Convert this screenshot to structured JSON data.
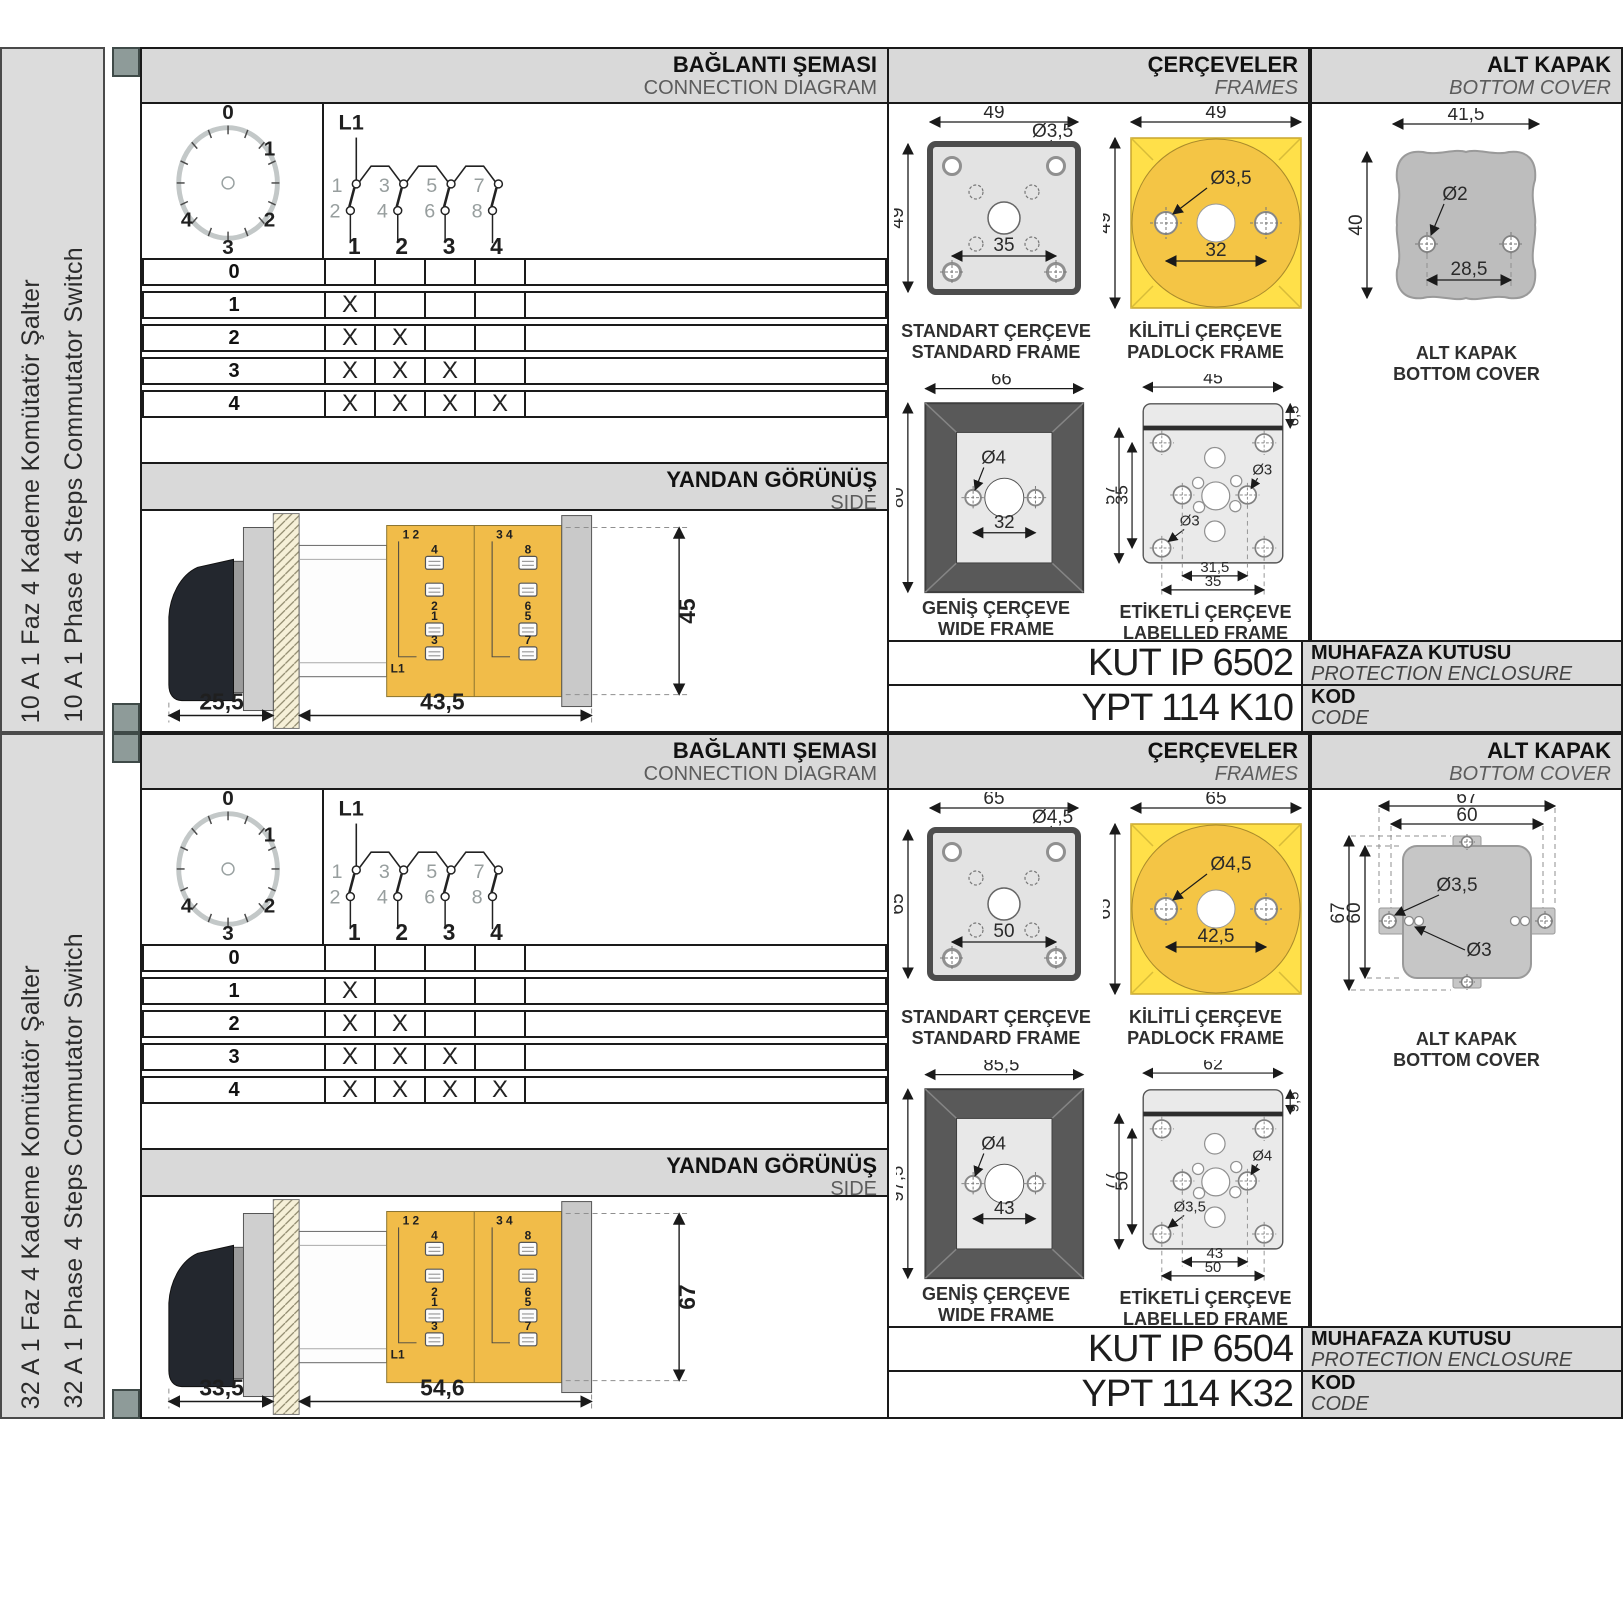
{
  "rows": [
    {
      "sidebar": {
        "title_tr": "10 A 1 Faz 4 Kademe Komütatör Şalter",
        "title_en": "10 A 1 Phase 4 Steps Commutator Switch"
      },
      "connection": {
        "title_tr": "BAĞLANTI ŞEMASI",
        "title_en": "CONNECTION DIAGRAM",
        "dial": {
          "labels": [
            "0",
            "1",
            "2",
            "3",
            "4"
          ]
        },
        "schematic": {
          "input": "L1",
          "top_terminals": [
            "1",
            "3",
            "5",
            "7"
          ],
          "bottom_terminals": [
            "2",
            "4",
            "6",
            "8"
          ],
          "poles": [
            "1",
            "2",
            "3",
            "4"
          ]
        },
        "table": {
          "steps": [
            {
              "step": "0",
              "marks": [
                "",
                "",
                "",
                ""
              ]
            },
            {
              "step": "1",
              "marks": [
                "X",
                "",
                "",
                ""
              ]
            },
            {
              "step": "2",
              "marks": [
                "X",
                "X",
                "",
                ""
              ]
            },
            {
              "step": "3",
              "marks": [
                "X",
                "X",
                "X",
                ""
              ]
            },
            {
              "step": "4",
              "marks": [
                "X",
                "X",
                "X",
                "X"
              ]
            }
          ]
        }
      },
      "side_view": {
        "title_tr": "YANDAN GÖRÜNÜŞ",
        "title_en": "SIDE",
        "dim_handle_depth": "25,5",
        "dim_body_depth": "43,5",
        "dim_height": "45",
        "terminals": {
          "group1": "1 2",
          "group2": "3 4",
          "labels": [
            "4",
            "8",
            "2",
            "6",
            "1",
            "5",
            "3",
            "7"
          ],
          "input": "L1"
        }
      },
      "frames": {
        "title_tr": "ÇERÇEVELER",
        "title_en": "FRAMES",
        "standard": {
          "caption_tr": "STANDART ÇERÇEVE",
          "caption_en": "STANDARD FRAME",
          "dim_width": "49",
          "dim_height": "49",
          "dim_hole": "Ø3,5",
          "dim_pitch": "35"
        },
        "padlock": {
          "caption_tr": "KİLİTLİ ÇERÇEVE",
          "caption_en": "PADLOCK FRAME",
          "dim_width": "49",
          "dim_height": "49",
          "dim_hole": "Ø3,5",
          "dim_pitch": "32"
        },
        "wide": {
          "caption_tr": "GENİŞ ÇERÇEVE",
          "caption_en": "WIDE FRAME",
          "dim_width": "66",
          "dim_height": "80",
          "dim_hole": "Ø4",
          "dim_pitch": "32"
        },
        "labelled": {
          "caption_tr": "ETİKETLİ ÇERÇEVE",
          "caption_en": "LABELLED FRAME",
          "dim_width": "45",
          "dim_band": "6,5",
          "dim_height": "57",
          "dim_inner_height": "35",
          "dim_hole_mid": "Ø3",
          "dim_hole_corner": "Ø3",
          "dim_pitch_inner": "31,5",
          "dim_pitch_outer": "35"
        }
      },
      "bottom_cover": {
        "title_tr": "ALT KAPAK",
        "title_en": "BOTTOM COVER",
        "caption_tr": "ALT KAPAK",
        "caption_en": "BOTTOM COVER",
        "dim_width": "41,5",
        "dim_hole": "Ø2",
        "dim_height": "40",
        "dim_pitch": "28,5"
      },
      "enclosure": {
        "code": "KUT IP 6502",
        "label_tr": "MUHAFAZA KUTUSU",
        "label_en": "PROTECTION ENCLOSURE"
      },
      "product_code": {
        "value": "YPT 114 K10",
        "label_tr": "KOD",
        "label_en": "CODE"
      }
    },
    {
      "sidebar": {
        "title_tr": "32 A 1 Faz 4 Kademe Komütatör Şalter",
        "title_en": "32 A 1 Phase 4 Steps Commutator Switch"
      },
      "connection": {
        "title_tr": "BAĞLANTI ŞEMASI",
        "title_en": "CONNECTION DIAGRAM",
        "dial": {
          "labels": [
            "0",
            "1",
            "2",
            "3",
            "4"
          ]
        },
        "schematic": {
          "input": "L1",
          "top_terminals": [
            "1",
            "3",
            "5",
            "7"
          ],
          "bottom_terminals": [
            "2",
            "4",
            "6",
            "8"
          ],
          "poles": [
            "1",
            "2",
            "3",
            "4"
          ]
        },
        "table": {
          "steps": [
            {
              "step": "0",
              "marks": [
                "",
                "",
                "",
                ""
              ]
            },
            {
              "step": "1",
              "marks": [
                "X",
                "",
                "",
                ""
              ]
            },
            {
              "step": "2",
              "marks": [
                "X",
                "X",
                "",
                ""
              ]
            },
            {
              "step": "3",
              "marks": [
                "X",
                "X",
                "X",
                ""
              ]
            },
            {
              "step": "4",
              "marks": [
                "X",
                "X",
                "X",
                "X"
              ]
            }
          ]
        }
      },
      "side_view": {
        "title_tr": "YANDAN GÖRÜNÜŞ",
        "title_en": "SIDE",
        "dim_handle_depth": "33,5",
        "dim_body_depth": "54,6",
        "dim_height": "67",
        "terminals": {
          "group1": "1 2",
          "group2": "3 4",
          "labels": [
            "4",
            "8",
            "2",
            "6",
            "1",
            "5",
            "3",
            "7"
          ],
          "input": "L1"
        }
      },
      "frames": {
        "title_tr": "ÇERÇEVELER",
        "title_en": "FRAMES",
        "standard": {
          "caption_tr": "STANDART ÇERÇEVE",
          "caption_en": "STANDARD FRAME",
          "dim_width": "65",
          "dim_height": "65",
          "dim_hole": "Ø4,5",
          "dim_pitch": "50"
        },
        "padlock": {
          "caption_tr": "KİLİTLİ ÇERÇEVE",
          "caption_en": "PADLOCK FRAME",
          "dim_width": "65",
          "dim_height": "65",
          "dim_hole": "Ø4,5",
          "dim_pitch": "42,5"
        },
        "wide": {
          "caption_tr": "GENİŞ ÇERÇEVE",
          "caption_en": "WIDE FRAME",
          "dim_width": "85,5",
          "dim_height": "97,5",
          "dim_hole": "Ø4",
          "dim_pitch": "43"
        },
        "labelled": {
          "caption_tr": "ETİKETLİ ÇERÇEVE",
          "caption_en": "LABELLED FRAME",
          "dim_width": "62",
          "dim_band": "9,5",
          "dim_height": "77",
          "dim_inner_height": "50",
          "dim_hole_mid": "Ø4",
          "dim_hole_corner": "Ø3,5",
          "dim_pitch_inner": "43",
          "dim_pitch_outer": "50"
        }
      },
      "bottom_cover": {
        "title_tr": "ALT KAPAK",
        "title_en": "BOTTOM COVER",
        "caption_tr": "ALT KAPAK",
        "caption_en": "BOTTOM COVER",
        "dim_width": "67",
        "dim_width_inner": "60",
        "dim_height": "67",
        "dim_height_inner": "60",
        "dim_hole": "Ø3,5",
        "dim_hole_small": "Ø3"
      },
      "enclosure": {
        "code": "KUT IP 6504",
        "label_tr": "MUHAFAZA KUTUSU",
        "label_en": "PROTECTION ENCLOSURE"
      },
      "product_code": {
        "value": "YPT 114 K32",
        "label_tr": "KOD",
        "label_en": "CODE"
      }
    }
  ]
}
